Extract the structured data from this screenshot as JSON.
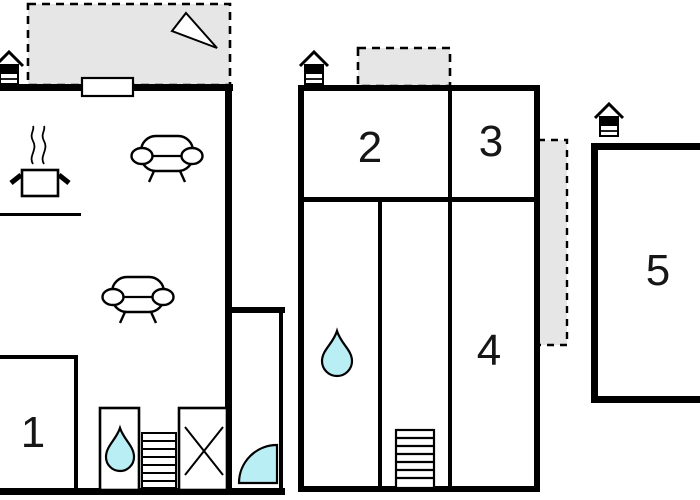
{
  "rooms": [
    {
      "name": "room-1",
      "label": "1"
    },
    {
      "name": "room-2",
      "label": "2"
    },
    {
      "name": "room-3",
      "label": "3"
    },
    {
      "name": "room-4",
      "label": "4"
    },
    {
      "name": "room-5",
      "label": "5"
    }
  ],
  "colors": {
    "wall": "#000000",
    "terrace_fill": "#e6e6e6",
    "water_fill": "#b9eef4",
    "background": "#ffffff"
  },
  "icons": [
    "north-arrow-icon",
    "entrance-house-icon-left",
    "entrance-house-icon-middle",
    "entrance-house-icon-right",
    "window-icon",
    "stove-pot-icon",
    "steam-icon",
    "sofa-icon-top",
    "sofa-icon-bottom",
    "water-drop-icon-left",
    "water-drop-icon-middle",
    "stairs-icon-left",
    "stairs-icon-middle",
    "wardrobe-x-icon",
    "door-swing-icon",
    "terrace-top-left",
    "terrace-middle",
    "balcony-right"
  ]
}
